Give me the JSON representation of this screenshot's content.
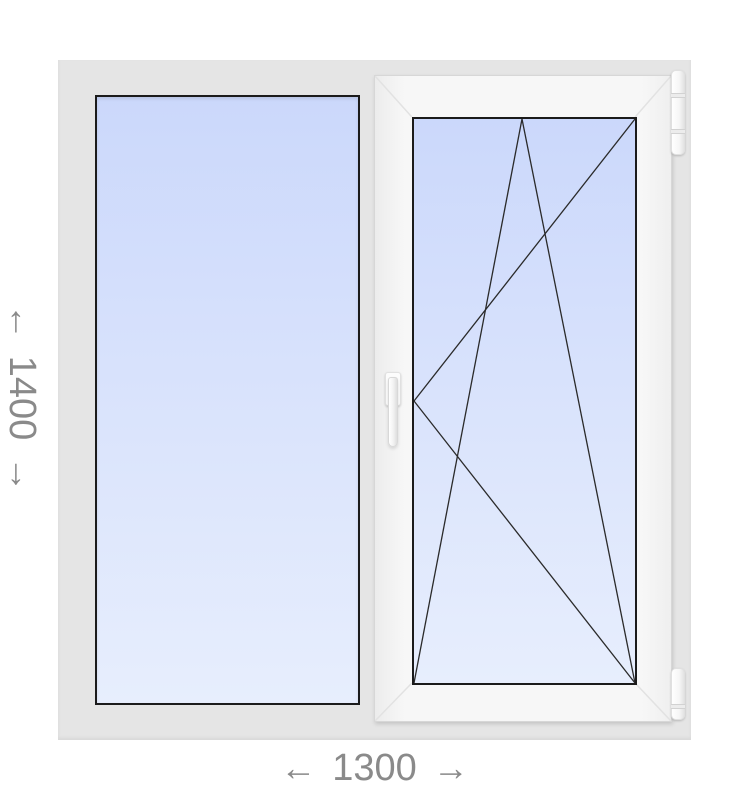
{
  "dimension_labels": {
    "height": {
      "arrow_start": "←",
      "value": "1400",
      "arrow_end": "→"
    },
    "width": {
      "arrow_start": "←",
      "value": "1300",
      "arrow_end": "→"
    }
  },
  "colors": {
    "backdrop_frame": "#e5e5e5",
    "sash_frame": "#f7f7f7",
    "glass_top": "#cbd8fb",
    "glass_bottom": "#e7eefd",
    "glass_outline": "#1b1b1b",
    "opening_lines": "#2a2a2a",
    "miter_lines": "#e2e2e2",
    "dimension_text": "#8a8a8a"
  },
  "parts": {
    "left_pane": "fixed-glazing-pane",
    "right_pane": "tilt-and-turn-sash",
    "opening_marks": [
      "turn-triangle-lines",
      "tilt-triangle-lines"
    ],
    "hardware": [
      "window-handle",
      "top-hinge",
      "bottom-hinge"
    ]
  }
}
